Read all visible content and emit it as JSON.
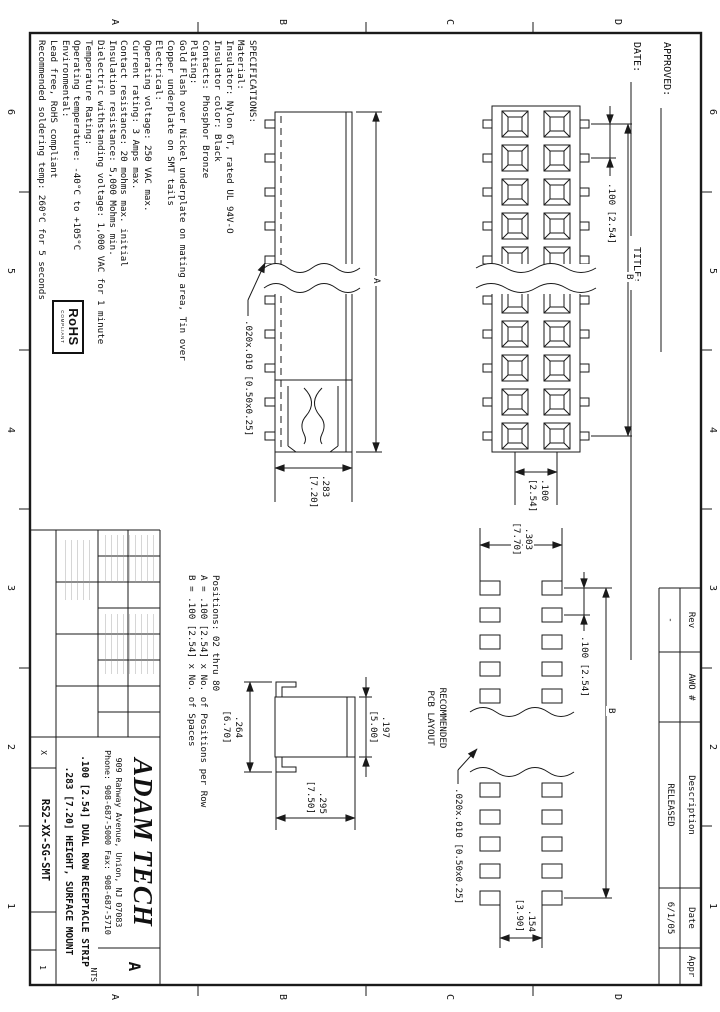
{
  "zones": {
    "columns": [
      "6",
      "5",
      "4",
      "3",
      "2",
      "1"
    ],
    "rows": [
      "D",
      "C",
      "B",
      "A"
    ]
  },
  "approval": {
    "approved": "APPROVED:",
    "date": "DATE:",
    "title": "TITLE:"
  },
  "specs": {
    "lines": [
      "SPECIFICATIONS:",
      "Material:",
      "Insulator: Nylon 6T, rated UL 94V-O",
      "Insulator color: Black",
      "Contacts: Phosphor Bronze",
      "Plating:",
      "Gold Flash over Nickel underplate on mating area, Tin over",
      "Copper underplate on SMT tails",
      "Electrical:",
      "Operating voltage: 250 VAC max.",
      "Current rating: 3 Amps max.",
      "Contact resistance: 20 mohms max. initial",
      "Insulation resistance: 5,000 Mohms min.",
      "Dielectric withstanding voltage: 1,000 VAC for 1 minute",
      "Temperature Rating:",
      "Operating temperature: -40°C to +105°C",
      "Environmental:",
      "Lead free, RoHS compliant",
      "Recommended soldering temp: 260°C for 5 seconds"
    ]
  },
  "rohs": {
    "name": "RoHS",
    "compliant": "COMPLIANT"
  },
  "notes": {
    "positions": "Positions: 02 thru 80",
    "formula_a": "A = .100 [2.54] x No. of Positions per Row",
    "formula_b": "B = .100 [2.54] x No. of Spaces"
  },
  "top_view": {
    "pitch": ".100 [2.54]",
    "span": "B",
    "row_in": ".100",
    "row_mm": "[2.54]"
  },
  "side_view": {
    "length": "A",
    "tail": ".020x.010 [0.50x0.25]",
    "height_in": ".283",
    "height_mm": "[7.20]"
  },
  "end_view": {
    "top_in": ".197",
    "top_mm": "[5.00]",
    "base_in": ".264",
    "base_mm": "[6.70]",
    "height_in": ".295",
    "height_mm": "[7.50]"
  },
  "pcb": {
    "caption_1": "RECOMMENDED",
    "caption_2": "PCB LAYOUT",
    "pad": ".020x.010 [0.50x0.25]",
    "span_in": ".303",
    "span_mm": "[7.70]",
    "pitch": ".100 [2.54]",
    "overall": "B",
    "gap_in": ".154",
    "gap_mm": "[3.90]"
  },
  "revisions": {
    "headers": [
      "Rev",
      "AWO #",
      "Description",
      "Date",
      "Appr"
    ],
    "rows": [
      [
        "-",
        "",
        "RELEASED",
        "6/1/05",
        ""
      ]
    ]
  },
  "title_block": {
    "company": "ADAM TECH",
    "address": "909 Rahway Avenue, Union, NJ 07083",
    "phone": "Phone: 908-687-5000 Fax: 908-687-5710",
    "description_1": ".100 [2.54] DUAL ROW RECEPTACLE STRIP",
    "description_2": ".283 [7.20] HEIGHT, SURFACE MOUNT",
    "part_number": "RS2-XX-SG-SMT",
    "size": "A",
    "scale": "NTS",
    "sheet": "1",
    "tolerance": "X"
  }
}
